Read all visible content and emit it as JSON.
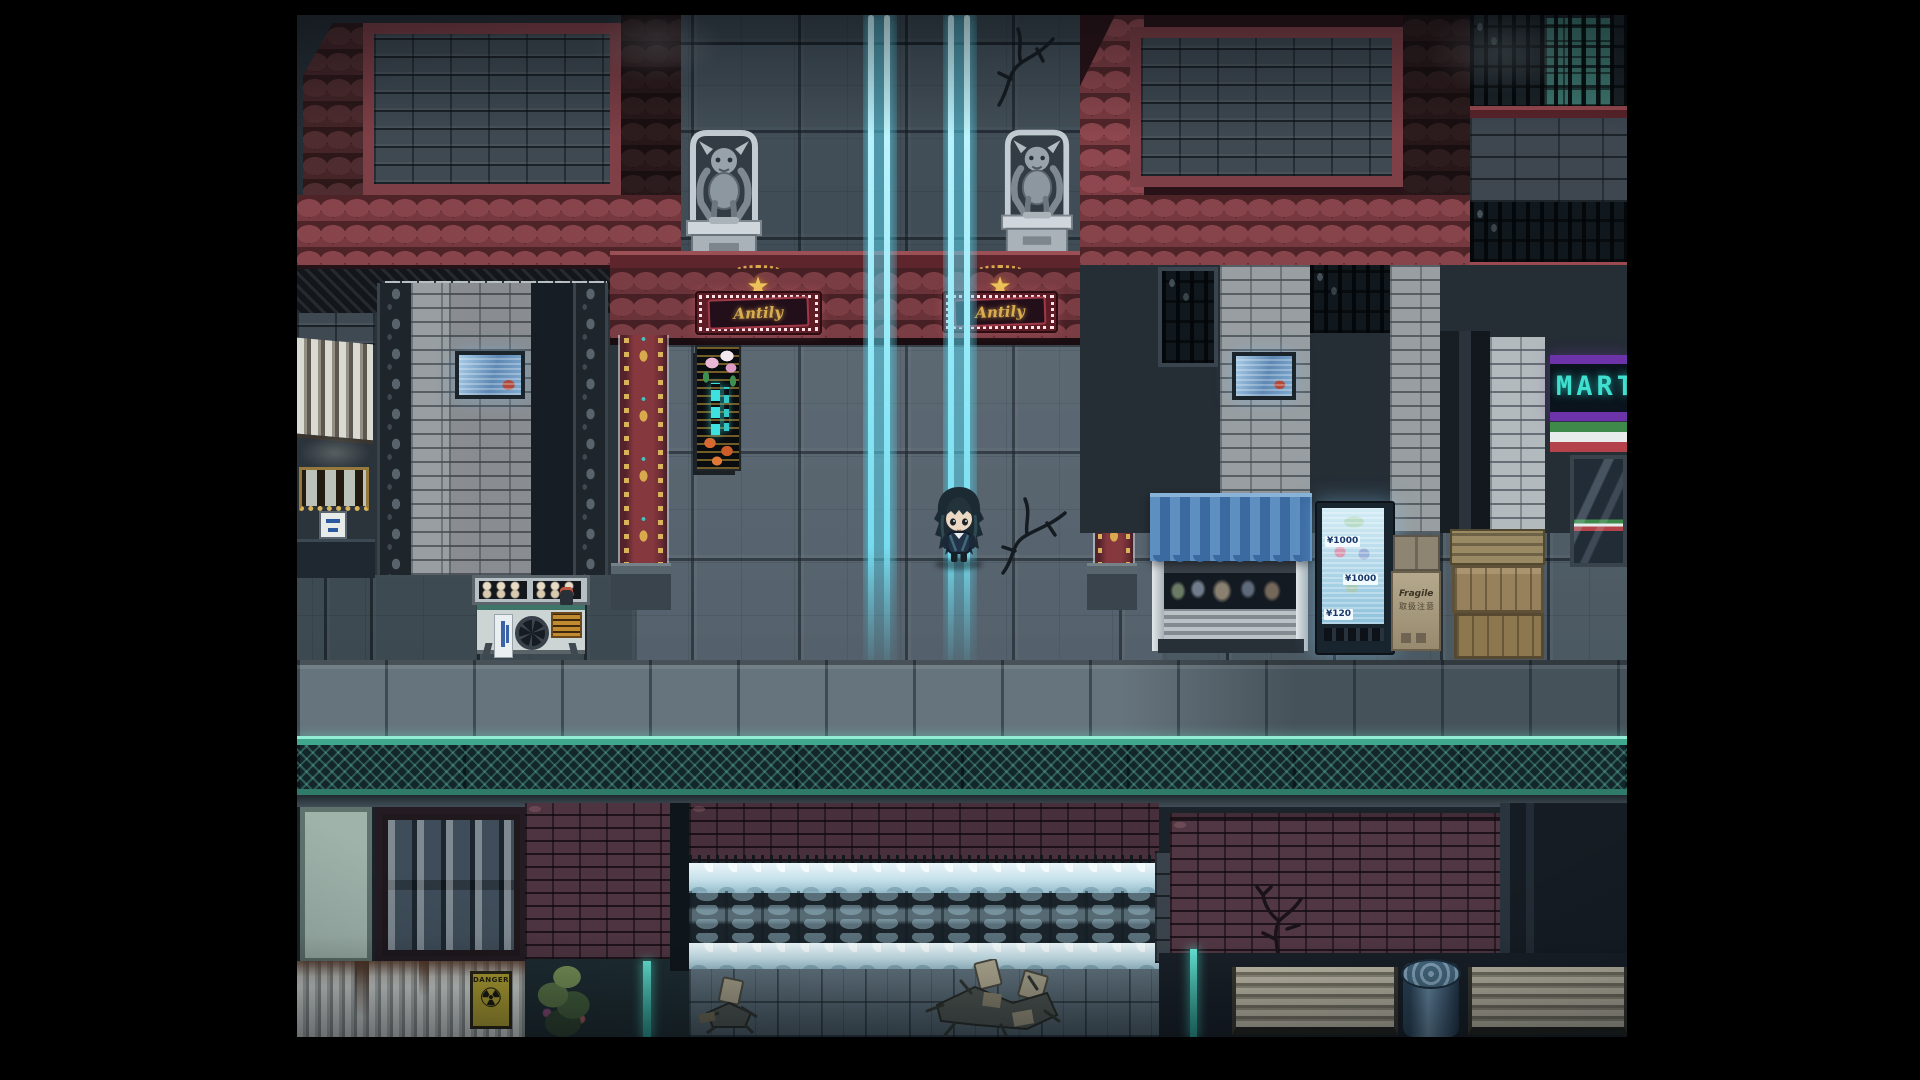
{
  "scene": {
    "title": "night-city-street-map",
    "genre": "top-down RPG",
    "description": "Dark rain-washed city block with a gargoyle gate, neon signs, canal weir and street clutter"
  },
  "signs": {
    "marquee_left": {
      "text": "Antily"
    },
    "marquee_right": {
      "text": "Antily"
    },
    "store_neon": {
      "text": "MART"
    },
    "danger": {
      "text": "DANGER"
    },
    "fragile": {
      "line1": "Fragile",
      "line2": "取扱注意"
    }
  },
  "vending": {
    "prices": [
      "¥1000",
      "¥1000",
      "¥120"
    ]
  },
  "character": {
    "id": "player",
    "description": "chibi hero with long dark hair standing on light beam",
    "facing": "down"
  },
  "objects": {
    "gargoyle_left": "stone gargoyle statue",
    "gargoyle_right": "stone gargoyle statue",
    "light_beam_left": "cyan light pillar",
    "light_beam_right": "cyan light pillar",
    "food_cart": "street food cart",
    "kiosk": "blue awning kiosk",
    "vending_machine": "backlit vending machine",
    "boxes": "cardboard boxes and wooden crates",
    "trash_can": "metal trash can",
    "benches": "wooden benches",
    "waterfall": "canal weir waterfall",
    "junk_piles": "broken furniture piles",
    "green_junk": "overgrown trash heap",
    "metal_door": "reinforced metal door",
    "radiation_shutter": "rusted shutter with danger sign",
    "neon_flower_sign": "vertical neon flower sign"
  },
  "colors": {
    "beam": "#7fe4f4",
    "fence": "#5ecfb4",
    "roof": "#7a3a3c",
    "marquee_gold": "#d9ae4e",
    "neon_teal": "#3fd4c8",
    "awning_blue": "#4a7eb4"
  }
}
